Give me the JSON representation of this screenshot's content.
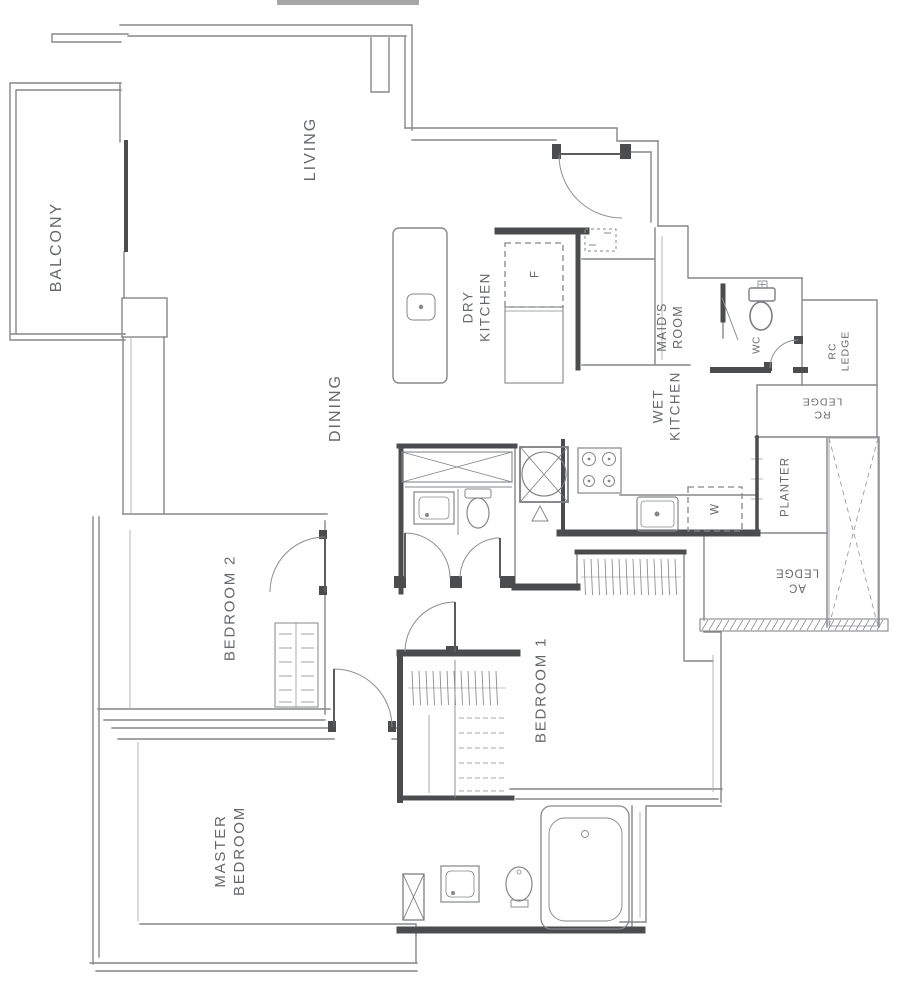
{
  "drawing": {
    "kind": "residential floor plan"
  },
  "labels": {
    "balcony": "BALCONY",
    "living": "LIVING",
    "dining": "DINING",
    "dry_kitchen": "DRY\nKITCHEN",
    "wet_kitchen": "WET\nKITCHEN",
    "maids_room": "MAID'S\nROOM",
    "wc": "WC",
    "rc_ledge_upper": "RC\nLEDGE",
    "rc_ledge_lower": "RC\nLEDGE",
    "planter": "PLANTER",
    "ac_ledge": "AC\nLEDGE",
    "bedroom_2": "BEDROOM 2",
    "bedroom_1": "BEDROOM 1",
    "master_bedroom": "MASTER\nBEDROOM",
    "fridge": "F",
    "washer": "W"
  },
  "fixture_icons": [
    "entrance-door-swing-icon",
    "balcony-sliding-door-icon",
    "kitchen-island-sink-icon",
    "refrigerator-box-icon",
    "db-box-icon",
    "vanity-counter-icon",
    "wash-basin-icon",
    "toilet-icon",
    "shower-stall-icon",
    "floor-trap-icon",
    "cooker-hob-icon",
    "kitchen-sink-icon",
    "washing-machine-box-icon",
    "maid-wc-toilet-icon",
    "bathtub-icon",
    "master-basin-icon",
    "master-toilet-icon",
    "wardrobe-hanger-icon",
    "wardrobe-shelf-icon",
    "ac-ledge-hatch-icon",
    "void-cross-icon",
    "column-cross-icon"
  ],
  "colors": {
    "background": "#ffffff",
    "wall": "#85878a",
    "wall_dark": "#4b4c4e",
    "label_text": "#66696c"
  }
}
